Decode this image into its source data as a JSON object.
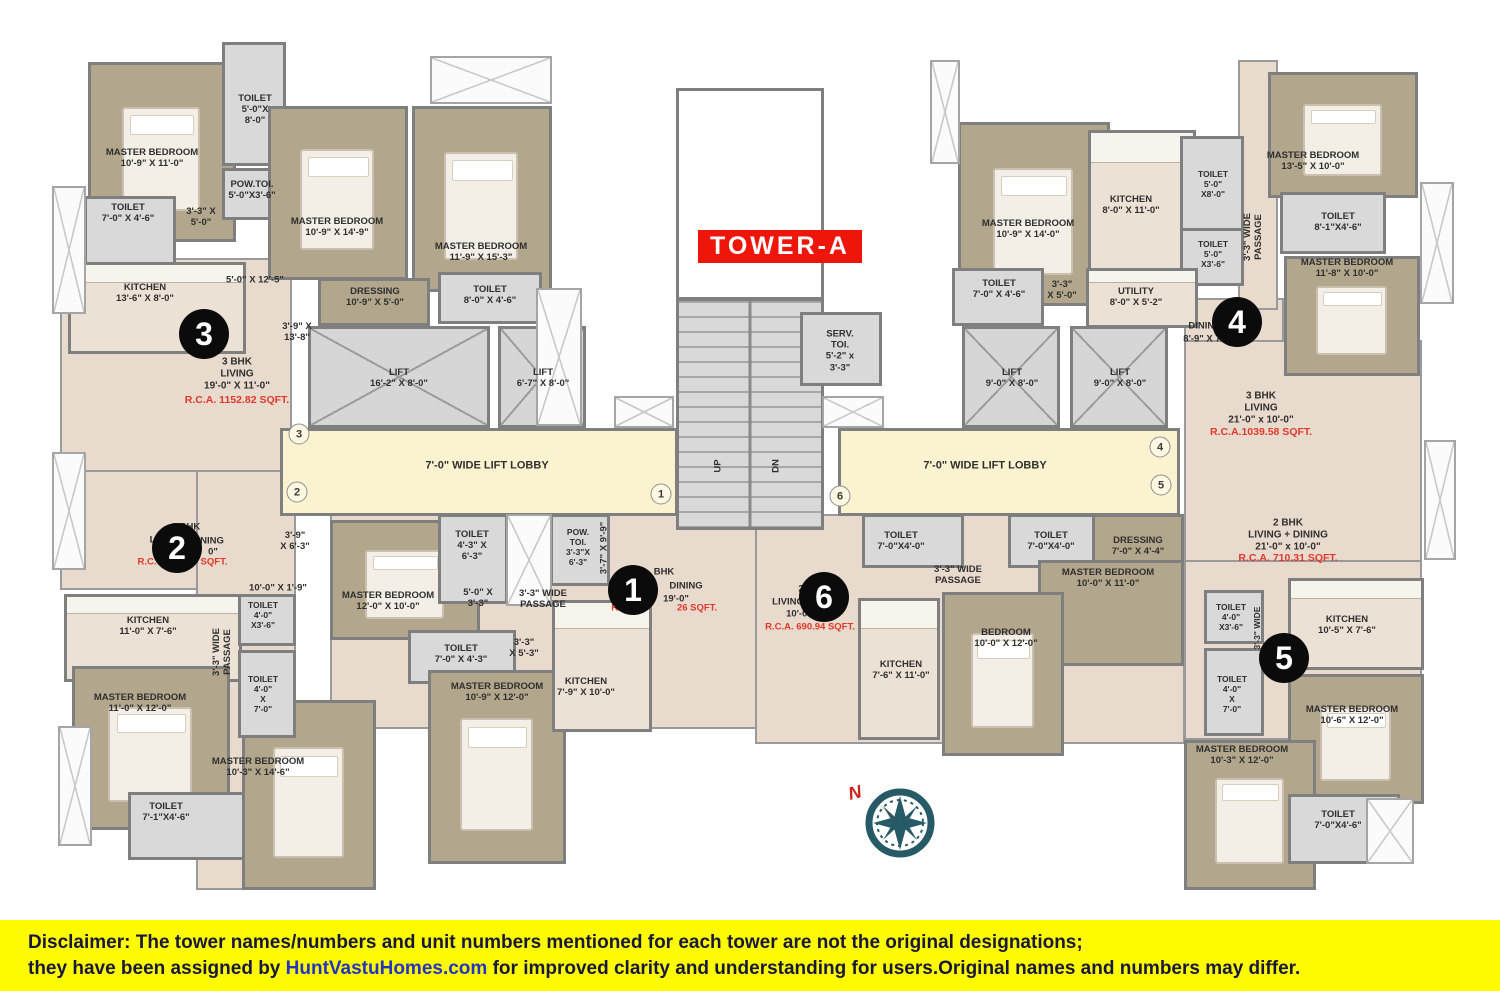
{
  "title": {
    "label": "TOWER-A"
  },
  "compass": {
    "north_label": "N"
  },
  "disclaimer": {
    "prefix": "Disclaimer:",
    "line1_rest": " The tower names/numbers and unit numbers mentioned for each tower are not the original designations;",
    "line2_pre": "they have been assigned by ",
    "link": "HuntVastuHomes.com",
    "line2_post": " for improved clarity and understanding for users.Original names and numbers may differ."
  },
  "colors": {
    "accent_red": "#ee150b",
    "red_text": "#e0382b",
    "lobby": "#fbf3cf",
    "bedroom_fill": "#b2a78c",
    "toilet_fill": "#d9d9d9",
    "living_fill": "#e8dacc",
    "wall": "#7f7f7f",
    "disclaimer_bg": "#fefb00",
    "compass_teal": "#265a66"
  },
  "unit_badges": [
    {
      "n": "1",
      "x": 633,
      "y": 590
    },
    {
      "n": "2",
      "x": 177,
      "y": 548
    },
    {
      "n": "3",
      "x": 204,
      "y": 334
    },
    {
      "n": "4",
      "x": 1237,
      "y": 322
    },
    {
      "n": "5",
      "x": 1284,
      "y": 658
    },
    {
      "n": "6",
      "x": 824,
      "y": 597
    }
  ],
  "door_markers": [
    {
      "n": "3",
      "x": 299,
      "y": 434
    },
    {
      "n": "2",
      "x": 297,
      "y": 492
    },
    {
      "n": "1",
      "x": 661,
      "y": 494
    },
    {
      "n": "6",
      "x": 840,
      "y": 496
    },
    {
      "n": "4",
      "x": 1160,
      "y": 447
    },
    {
      "n": "5",
      "x": 1161,
      "y": 485
    }
  ],
  "plan": {
    "zones": [
      {
        "name": "unit-3-living-zone",
        "x": 60,
        "y": 258,
        "w": 232,
        "h": 215
      },
      {
        "name": "unit-2-living-zone",
        "x": 60,
        "y": 470,
        "w": 232,
        "h": 120
      },
      {
        "name": "left-passage-zone",
        "x": 196,
        "y": 470,
        "w": 100,
        "h": 420
      },
      {
        "name": "unit-1-zone",
        "x": 330,
        "y": 514,
        "w": 455,
        "h": 215
      },
      {
        "name": "unit-6-zone",
        "x": 755,
        "y": 514,
        "w": 430,
        "h": 230
      },
      {
        "name": "unit-4-dining-zone",
        "x": 1184,
        "y": 298,
        "w": 100,
        "h": 142
      },
      {
        "name": "unit-4-living-zone",
        "x": 1184,
        "y": 340,
        "w": 238,
        "h": 222
      },
      {
        "name": "unit-5-zone",
        "x": 1184,
        "y": 560,
        "w": 238,
        "h": 180
      },
      {
        "name": "right-top-passage-zone",
        "x": 1238,
        "y": 60,
        "w": 40,
        "h": 250
      }
    ],
    "rooms": [
      {
        "name": "master-bedroom",
        "type": "bed",
        "x": 88,
        "y": 62,
        "w": 148,
        "h": 180
      },
      {
        "name": "toilet",
        "type": "toilet",
        "x": 222,
        "y": 42,
        "w": 64,
        "h": 124
      },
      {
        "name": "pow-toi",
        "type": "toilet",
        "x": 222,
        "y": 168,
        "w": 64,
        "h": 52
      },
      {
        "name": "toilet",
        "type": "toilet",
        "x": 84,
        "y": 196,
        "w": 92,
        "h": 72
      },
      {
        "name": "master-bedroom",
        "type": "bed",
        "x": 268,
        "y": 106,
        "w": 140,
        "h": 174
      },
      {
        "name": "master-bedroom",
        "type": "bed",
        "x": 412,
        "y": 106,
        "w": 140,
        "h": 186
      },
      {
        "name": "kitchen",
        "type": "kitchen",
        "x": 68,
        "y": 262,
        "w": 178,
        "h": 92
      },
      {
        "name": "dressing",
        "type": "bed",
        "x": 318,
        "y": 278,
        "w": 112,
        "h": 48
      },
      {
        "name": "toilet",
        "type": "toilet",
        "x": 438,
        "y": 272,
        "w": 104,
        "h": 52
      },
      {
        "name": "kitchen",
        "type": "kitchen",
        "x": 64,
        "y": 594,
        "w": 178,
        "h": 88
      },
      {
        "name": "master-bedroom",
        "type": "bed",
        "x": 72,
        "y": 666,
        "w": 158,
        "h": 164
      },
      {
        "name": "toilet",
        "type": "toilet",
        "x": 128,
        "y": 792,
        "w": 124,
        "h": 68
      },
      {
        "name": "master-bedroom",
        "type": "bed",
        "x": 242,
        "y": 700,
        "w": 134,
        "h": 190
      },
      {
        "name": "toilet",
        "type": "toilet",
        "x": 238,
        "y": 594,
        "w": 58,
        "h": 52
      },
      {
        "name": "toilet",
        "type": "toilet",
        "x": 238,
        "y": 650,
        "w": 58,
        "h": 88
      },
      {
        "name": "master-bedroom",
        "type": "bed",
        "x": 330,
        "y": 520,
        "w": 150,
        "h": 120
      },
      {
        "name": "toilet",
        "type": "toilet",
        "x": 438,
        "y": 514,
        "w": 70,
        "h": 90
      },
      {
        "name": "pow-toi",
        "type": "toilet",
        "x": 550,
        "y": 514,
        "w": 60,
        "h": 72
      },
      {
        "name": "toilet",
        "type": "toilet",
        "x": 408,
        "y": 630,
        "w": 108,
        "h": 54
      },
      {
        "name": "master-bedroom",
        "type": "bed",
        "x": 428,
        "y": 670,
        "w": 138,
        "h": 194
      },
      {
        "name": "kitchen",
        "type": "kitchen",
        "x": 552,
        "y": 600,
        "w": 100,
        "h": 132
      },
      {
        "name": "stair-shaft",
        "type": "shaft",
        "x": 676,
        "y": 88,
        "w": 148,
        "h": 212
      },
      {
        "name": "staircase",
        "type": "stairs",
        "x": 676,
        "y": 298,
        "w": 148,
        "h": 232
      },
      {
        "name": "serv-toi",
        "type": "toilet",
        "x": 800,
        "y": 312,
        "w": 82,
        "h": 74
      },
      {
        "name": "lift",
        "type": "lift",
        "x": 308,
        "y": 326,
        "w": 182,
        "h": 102
      },
      {
        "name": "lift",
        "type": "lift",
        "x": 498,
        "y": 326,
        "w": 88,
        "h": 102
      },
      {
        "name": "lift-lobby",
        "type": "lobby",
        "x": 280,
        "y": 428,
        "w": 398,
        "h": 88
      },
      {
        "name": "lift-lobby",
        "type": "lobby",
        "x": 838,
        "y": 428,
        "w": 342,
        "h": 88
      },
      {
        "name": "lift",
        "type": "lift",
        "x": 962,
        "y": 326,
        "w": 98,
        "h": 102
      },
      {
        "name": "lift",
        "type": "lift",
        "x": 1070,
        "y": 326,
        "w": 98,
        "h": 102
      },
      {
        "name": "master-bedroom",
        "type": "bed",
        "x": 958,
        "y": 122,
        "w": 152,
        "h": 184
      },
      {
        "name": "kitchen",
        "type": "kitchen",
        "x": 1088,
        "y": 130,
        "w": 108,
        "h": 150
      },
      {
        "name": "toilet",
        "type": "toilet",
        "x": 1180,
        "y": 136,
        "w": 64,
        "h": 110
      },
      {
        "name": "toilet",
        "type": "toilet",
        "x": 1180,
        "y": 228,
        "w": 64,
        "h": 58
      },
      {
        "name": "toilet",
        "type": "toilet",
        "x": 952,
        "y": 268,
        "w": 92,
        "h": 58
      },
      {
        "name": "utility",
        "type": "kitchen",
        "x": 1086,
        "y": 268,
        "w": 112,
        "h": 60
      },
      {
        "name": "master-bedroom",
        "type": "bed",
        "x": 1268,
        "y": 72,
        "w": 150,
        "h": 126
      },
      {
        "name": "toilet",
        "type": "toilet",
        "x": 1280,
        "y": 192,
        "w": 106,
        "h": 62
      },
      {
        "name": "master-bedroom",
        "type": "bed",
        "x": 1284,
        "y": 256,
        "w": 136,
        "h": 120
      },
      {
        "name": "toilet",
        "type": "toilet",
        "x": 862,
        "y": 514,
        "w": 102,
        "h": 54
      },
      {
        "name": "toilet",
        "type": "toilet",
        "x": 1008,
        "y": 514,
        "w": 102,
        "h": 54
      },
      {
        "name": "dressing",
        "type": "bed",
        "x": 1092,
        "y": 514,
        "w": 92,
        "h": 54
      },
      {
        "name": "master-bedroom",
        "type": "bed",
        "x": 1038,
        "y": 560,
        "w": 146,
        "h": 106
      },
      {
        "name": "bedroom",
        "type": "bed",
        "x": 942,
        "y": 592,
        "w": 122,
        "h": 164
      },
      {
        "name": "kitchen",
        "type": "kitchen",
        "x": 858,
        "y": 598,
        "w": 82,
        "h": 142
      },
      {
        "name": "toilet",
        "type": "toilet",
        "x": 1204,
        "y": 590,
        "w": 60,
        "h": 54
      },
      {
        "name": "toilet",
        "type": "toilet",
        "x": 1204,
        "y": 648,
        "w": 60,
        "h": 88
      },
      {
        "name": "kitchen",
        "type": "kitchen",
        "x": 1288,
        "y": 578,
        "w": 136,
        "h": 92
      },
      {
        "name": "master-bedroom",
        "type": "bed",
        "x": 1288,
        "y": 674,
        "w": 136,
        "h": 130
      },
      {
        "name": "master-bedroom",
        "type": "bed",
        "x": 1184,
        "y": 740,
        "w": 132,
        "h": 150
      },
      {
        "name": "toilet",
        "type": "toilet",
        "x": 1288,
        "y": 794,
        "w": 112,
        "h": 70
      }
    ],
    "balconies": [
      {
        "x": 52,
        "y": 186,
        "w": 34,
        "h": 128
      },
      {
        "x": 52,
        "y": 452,
        "w": 34,
        "h": 118
      },
      {
        "x": 58,
        "y": 726,
        "w": 34,
        "h": 120
      },
      {
        "x": 430,
        "y": 56,
        "w": 122,
        "h": 48
      },
      {
        "x": 506,
        "y": 514,
        "w": 46,
        "h": 92
      },
      {
        "x": 536,
        "y": 288,
        "w": 46,
        "h": 138
      },
      {
        "x": 614,
        "y": 396,
        "w": 60,
        "h": 32
      },
      {
        "x": 822,
        "y": 396,
        "w": 62,
        "h": 32
      },
      {
        "x": 930,
        "y": 60,
        "w": 30,
        "h": 104
      },
      {
        "x": 1420,
        "y": 182,
        "w": 34,
        "h": 122
      },
      {
        "x": 1424,
        "y": 440,
        "w": 32,
        "h": 120
      },
      {
        "x": 1366,
        "y": 798,
        "w": 48,
        "h": 66
      }
    ],
    "labels": [
      {
        "t": "MASTER BEDROOM\n10'-9\" X 11'-0\"",
        "x": 152,
        "y": 158
      },
      {
        "t": "TOILET\n5'-0\"X\n8'-0\"",
        "x": 255,
        "y": 110
      },
      {
        "t": "POW.TOI.\n5'-0\"X3'-6\"",
        "x": 252,
        "y": 190
      },
      {
        "t": "TOILET\n7'-0\" X 4'-6\"",
        "x": 128,
        "y": 213
      },
      {
        "t": "3'-3\" X\n5'-0\"",
        "x": 201,
        "y": 217
      },
      {
        "t": "MASTER BEDROOM\n10'-9\" X 14'-9\"",
        "x": 337,
        "y": 227
      },
      {
        "t": "MASTER BEDROOM\n11'-9\" X 15'-3\"",
        "x": 481,
        "y": 252
      },
      {
        "t": "KITCHEN\n13'-6\" X 8'-0\"",
        "x": 145,
        "y": 293
      },
      {
        "t": "5'-0\" X 12'-5\"",
        "x": 255,
        "y": 280
      },
      {
        "t": "DRESSING\n10'-9\" X 5'-0\"",
        "x": 375,
        "y": 297
      },
      {
        "t": "TOILET\n8'-0\" X 4'-6\"",
        "x": 490,
        "y": 295
      },
      {
        "t": "3'-9\" X\n13'-8\"",
        "x": 297,
        "y": 332
      },
      {
        "t": "3 BHK\nLIVING\n19'-0\" X 11'-0\"",
        "x": 237,
        "y": 374,
        "s": 10
      },
      {
        "t": "R.C.A. 1152.82 SQFT.",
        "x": 237,
        "y": 400,
        "c": "red",
        "s": 10.5
      },
      {
        "t": "LIFT\n16'-2\" X 8'-0\"",
        "x": 399,
        "y": 378
      },
      {
        "t": "LIFT\n6'-7\" X 8'-0\"",
        "x": 543,
        "y": 378
      },
      {
        "t": "7'-0\" WIDE LIFT LOBBY",
        "x": 487,
        "y": 466,
        "s": 11
      },
      {
        "t": "SERV.\nTOI.\n5'-2\" x\n3'-3\"",
        "x": 840,
        "y": 351
      },
      {
        "t": "UP",
        "x": 718,
        "y": 466,
        "r": 1
      },
      {
        "t": "DN",
        "x": 776,
        "y": 466,
        "r": 1
      },
      {
        "t": "7'-0\" WIDE LIFT LOBBY",
        "x": 985,
        "y": 466,
        "s": 11
      },
      {
        "t": "LIFT\n9'-0\" X 8'-0\"",
        "x": 1012,
        "y": 378
      },
      {
        "t": "LIFT\n9'-0\" X 8'-0\"",
        "x": 1120,
        "y": 378
      },
      {
        "t": "2 BHK",
        "x": 186,
        "y": 527
      },
      {
        "t": "LIV",
        "x": 157,
        "y": 540
      },
      {
        "t": "NING",
        "x": 212,
        "y": 541
      },
      {
        "t": "0\"",
        "x": 213,
        "y": 552
      },
      {
        "t": "R.C.",
        "x": 147,
        "y": 562,
        "c": "red"
      },
      {
        "t": "SQFT.",
        "x": 214,
        "y": 562,
        "c": "red"
      },
      {
        "t": "3'-9\"\nX 6'-3\"",
        "x": 295,
        "y": 541
      },
      {
        "t": "10'-0\" X 1'-9\"",
        "x": 278,
        "y": 588
      },
      {
        "t": "KITCHEN\n11'-0\" X 7'-6\"",
        "x": 148,
        "y": 626
      },
      {
        "t": "TOILET\n4'-0\"\nX3'-6\"",
        "x": 263,
        "y": 615,
        "s": 8.5
      },
      {
        "t": "TOILET\n4'-0\"\nX\n7'-0\"",
        "x": 263,
        "y": 694,
        "s": 8.5
      },
      {
        "t": "3'-3\" WIDE\nPASSAGE",
        "x": 222,
        "y": 652,
        "r": 1
      },
      {
        "t": "MASTER BEDROOM\n11'-0\" X 12'-0\"",
        "x": 140,
        "y": 703
      },
      {
        "t": "TOILET\n7'-1\"X4'-6\"",
        "x": 166,
        "y": 812
      },
      {
        "t": "MASTER BEDROOM\n10'-3\" X 14'-6\"",
        "x": 258,
        "y": 767
      },
      {
        "t": "MASTER BEDROOM\n12'-0\" X 10'-0\"",
        "x": 388,
        "y": 601
      },
      {
        "t": "TOILET\n4'-3\" X\n6'-3\"",
        "x": 472,
        "y": 546
      },
      {
        "t": "5'-0\" X\n3'-3\"",
        "x": 478,
        "y": 598
      },
      {
        "t": "3'-3\" WIDE\nPASSAGE",
        "x": 543,
        "y": 599
      },
      {
        "t": "POW.\nTOI.\n3'-3\"X\n6'-3\"",
        "x": 578,
        "y": 547,
        "s": 8.5
      },
      {
        "t": "3'-7\" X 9'-9\"",
        "x": 604,
        "y": 548,
        "r": 1
      },
      {
        "t": "TOILET\n7'-0\" X 4'-3\"",
        "x": 461,
        "y": 654
      },
      {
        "t": "3'-3\"\nX 5'-3\"",
        "x": 524,
        "y": 648
      },
      {
        "t": "MASTER BEDROOM\n10'-9\" X 12'-0\"",
        "x": 497,
        "y": 692
      },
      {
        "t": "KITCHEN\n7'-9\" X 10'-0\"",
        "x": 586,
        "y": 687
      },
      {
        "t": "BHK",
        "x": 664,
        "y": 572
      },
      {
        "t": "DINING",
        "x": 686,
        "y": 586
      },
      {
        "t": "19'-0\"",
        "x": 676,
        "y": 599
      },
      {
        "t": "R.",
        "x": 616,
        "y": 608,
        "c": "red"
      },
      {
        "t": "26 SQFT.",
        "x": 697,
        "y": 608,
        "c": "red"
      },
      {
        "t": "MASTER BEDROOM\n10'-9\" X 14'-0\"",
        "x": 1028,
        "y": 229
      },
      {
        "t": "KITCHEN\n8'-0\" X 11'-0\"",
        "x": 1131,
        "y": 205
      },
      {
        "t": "TOILET\n5'-0\"\nX8'-0\"",
        "x": 1213,
        "y": 184,
        "s": 8.5
      },
      {
        "t": "TOILET\n5'-0\"\nX3'-6\"",
        "x": 1213,
        "y": 254,
        "s": 8.5
      },
      {
        "t": "TOILET\n7'-0\" X 4'-6\"",
        "x": 999,
        "y": 289
      },
      {
        "t": "3'-3\"\nX 5'-0\"",
        "x": 1062,
        "y": 290
      },
      {
        "t": "UTILITY\n8'-0\" X 5'-2\"",
        "x": 1136,
        "y": 297
      },
      {
        "t": "3'-3\" WIDE\nPASSAGE",
        "x": 1253,
        "y": 237,
        "r": 1
      },
      {
        "t": "MASTER BEDROOM\n13'-5\" X 10'-0\"",
        "x": 1313,
        "y": 161
      },
      {
        "t": "TOILET\n8'-1\"X4'-6\"",
        "x": 1338,
        "y": 222
      },
      {
        "t": "MASTER BEDROOM\n11'-8\" X 10'-0\"",
        "x": 1347,
        "y": 268
      },
      {
        "t": "DINING",
        "x": 1205,
        "y": 326
      },
      {
        "t": "8'-9\" X 7",
        "x": 1202,
        "y": 339
      },
      {
        "t": "3 BHK\nLIVING\n21'-0\" x 10'-0\"",
        "x": 1261,
        "y": 408,
        "s": 10
      },
      {
        "t": "R.C.A.1039.58 SQFT.",
        "x": 1261,
        "y": 432,
        "c": "red",
        "s": 10.5
      },
      {
        "t": "2 BHK\nLIVING + DINING\n21'-0\" x 10'-0\"",
        "x": 1288,
        "y": 535,
        "s": 10
      },
      {
        "t": "R.C.A. 710.31 SQFT.",
        "x": 1288,
        "y": 558,
        "c": "red",
        "s": 10.5
      },
      {
        "t": "TOILET\n7'-0\"X4'-0\"",
        "x": 901,
        "y": 541
      },
      {
        "t": "TOILET\n7'-0\"X4'-0\"",
        "x": 1051,
        "y": 541
      },
      {
        "t": "3'-3\" WIDE\nPASSAGE",
        "x": 958,
        "y": 575
      },
      {
        "t": "DRESSING\n7'-0\" X 4'-4\"",
        "x": 1138,
        "y": 546
      },
      {
        "t": "MASTER BEDROOM\n10'-0\" X 11'-0\"",
        "x": 1108,
        "y": 578
      },
      {
        "t": "BEDROOM\n10'-0\" X 12'-0\"",
        "x": 1006,
        "y": 638
      },
      {
        "t": "KITCHEN\n7'-6\" X 11'-0\"",
        "x": 901,
        "y": 670
      },
      {
        "t": "2",
        "x": 801,
        "y": 589
      },
      {
        "t": "LIVING",
        "x": 788,
        "y": 602
      },
      {
        "t": "10'-0\"",
        "x": 799,
        "y": 614
      },
      {
        "t": "R.C.A. 690.94 SQFT.",
        "x": 810,
        "y": 627,
        "c": "red"
      },
      {
        "t": "TOILET\n4'-0\"\nX3'-6\"",
        "x": 1231,
        "y": 617,
        "s": 8.5
      },
      {
        "t": "TOILET\n4'-0\"\nX\n7'-0\"",
        "x": 1232,
        "y": 694,
        "s": 8.5
      },
      {
        "t": "KITCHEN\n10'-5\" X 7'-6\"",
        "x": 1347,
        "y": 625
      },
      {
        "t": "MASTER BEDROOM\n10'-6\" X 12'-0\"",
        "x": 1352,
        "y": 715
      },
      {
        "t": "MASTER BEDROOM\n10'-3\" X 12'-0\"",
        "x": 1242,
        "y": 755
      },
      {
        "t": "TOILET\n7'-0\"X4'-6\"",
        "x": 1338,
        "y": 820
      },
      {
        "t": "3'-3\" WIDE",
        "x": 1257,
        "y": 628,
        "r": 1,
        "s": 8.5
      }
    ]
  }
}
